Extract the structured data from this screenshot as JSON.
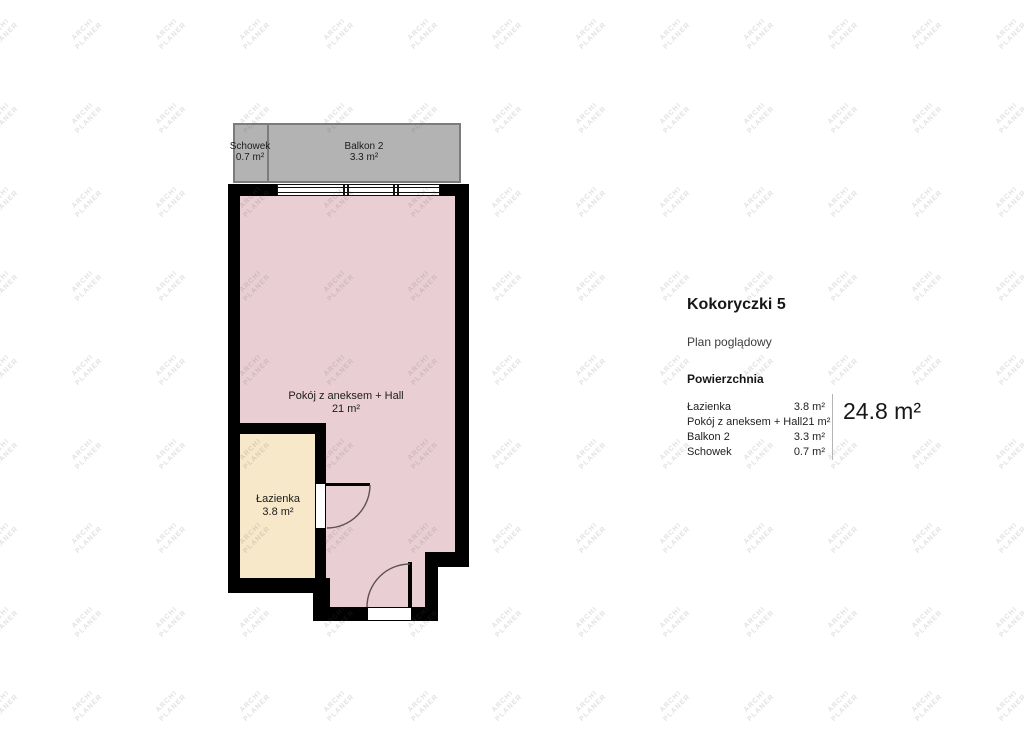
{
  "watermark": {
    "line1": "ARCHI",
    "line2": "PLANER"
  },
  "plan": {
    "rooms": [
      {
        "id": "schowek",
        "name": "Schowek",
        "area": "0.7 m²"
      },
      {
        "id": "balkon2",
        "name": "Balkon 2",
        "area": "3.3 m²"
      },
      {
        "id": "pokoj",
        "name": "Pokój z aneksem + Hall",
        "area": "21 m²"
      },
      {
        "id": "lazienka",
        "name": "Łazienka",
        "area": "3.8 m²"
      }
    ]
  },
  "panel": {
    "title": "Kokoryczki 5",
    "subtitle": "Plan poglądowy",
    "section_header": "Powierzchnia",
    "rows": [
      {
        "label": "Łazienka",
        "value": "3.8 m²"
      },
      {
        "label": "Pokój z aneksem + Hall",
        "value": "21 m²"
      },
      {
        "label": "Balkon 2",
        "value": "3.3 m²"
      },
      {
        "label": "Schowek",
        "value": "0.7 m²"
      }
    ],
    "total": "24.8 m²"
  },
  "colors": {
    "wall": "#000000",
    "room_fill": "#e9cfd3",
    "bathroom_fill": "#f6e8c8",
    "balcony_fill": "#b4b3b4",
    "balcony_border": "#7d7c7d",
    "watermark_text": "#5a5a5a",
    "divider": "#b5b5b5"
  }
}
